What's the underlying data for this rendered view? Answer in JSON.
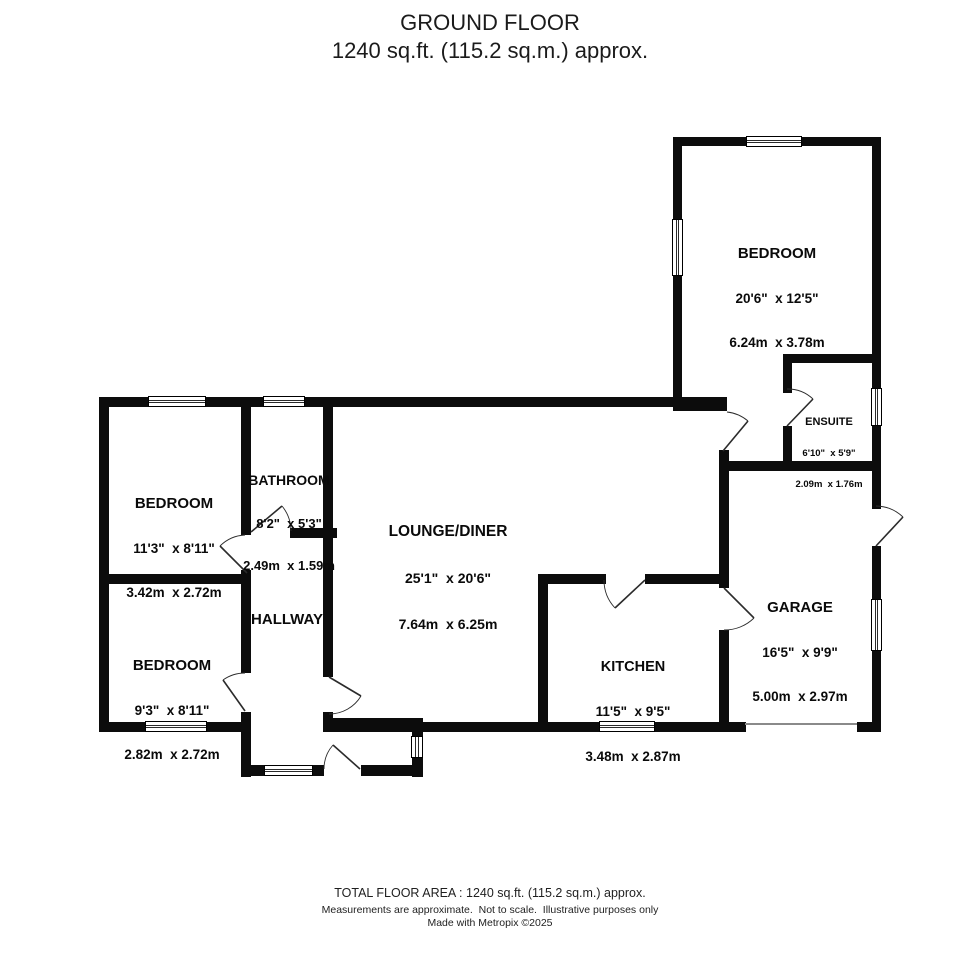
{
  "header": {
    "title": "GROUND FLOOR",
    "subtitle": "1240 sq.ft. (115.2 sq.m.) approx."
  },
  "rooms": {
    "bedroom_main": {
      "name": "BEDROOM",
      "imperial": "20'6\"  x 12'5\"",
      "metric": "6.24m  x 3.78m"
    },
    "ensuite": {
      "name": "ENSUITE",
      "imperial": "6'10\"  x 5'9\"",
      "metric": "2.09m  x 1.76m"
    },
    "bedroom_front": {
      "name": "BEDROOM",
      "imperial": "11'3\"  x 8'11\"",
      "metric": "3.42m  x 2.72m"
    },
    "bathroom": {
      "name": "BATHROOM",
      "imperial": "8'2\"  x 5'3\"",
      "metric": "2.49m  x 1.59m"
    },
    "lounge": {
      "name": "LOUNGE/DINER",
      "imperial": "25'1\"  x 20'6\"",
      "metric": "7.64m  x 6.25m"
    },
    "hallway": {
      "name": "HALLWAY"
    },
    "bedroom_rear": {
      "name": "BEDROOM",
      "imperial": "9'3\"  x 8'11\"",
      "metric": "2.82m  x 2.72m"
    },
    "kitchen": {
      "name": "KITCHEN",
      "imperial": "11'5\"  x 9'5\"",
      "metric": "3.48m  x 2.87m"
    },
    "garage": {
      "name": "GARAGE",
      "imperial": "16'5\"  x 9'9\"",
      "metric": "5.00m  x 2.97m"
    }
  },
  "footer": {
    "total": "TOTAL FLOOR AREA : 1240 sq.ft. (115.2 sq.m.) approx.",
    "disclaimer": "Measurements are approximate.  Not to scale.  Illustrative purposes only",
    "credit": "Made with Metropix ©2025"
  },
  "colors": {
    "wall": "#0c0c0c",
    "background": "#ffffff",
    "garage_opening_line": "#8a8a8a"
  }
}
